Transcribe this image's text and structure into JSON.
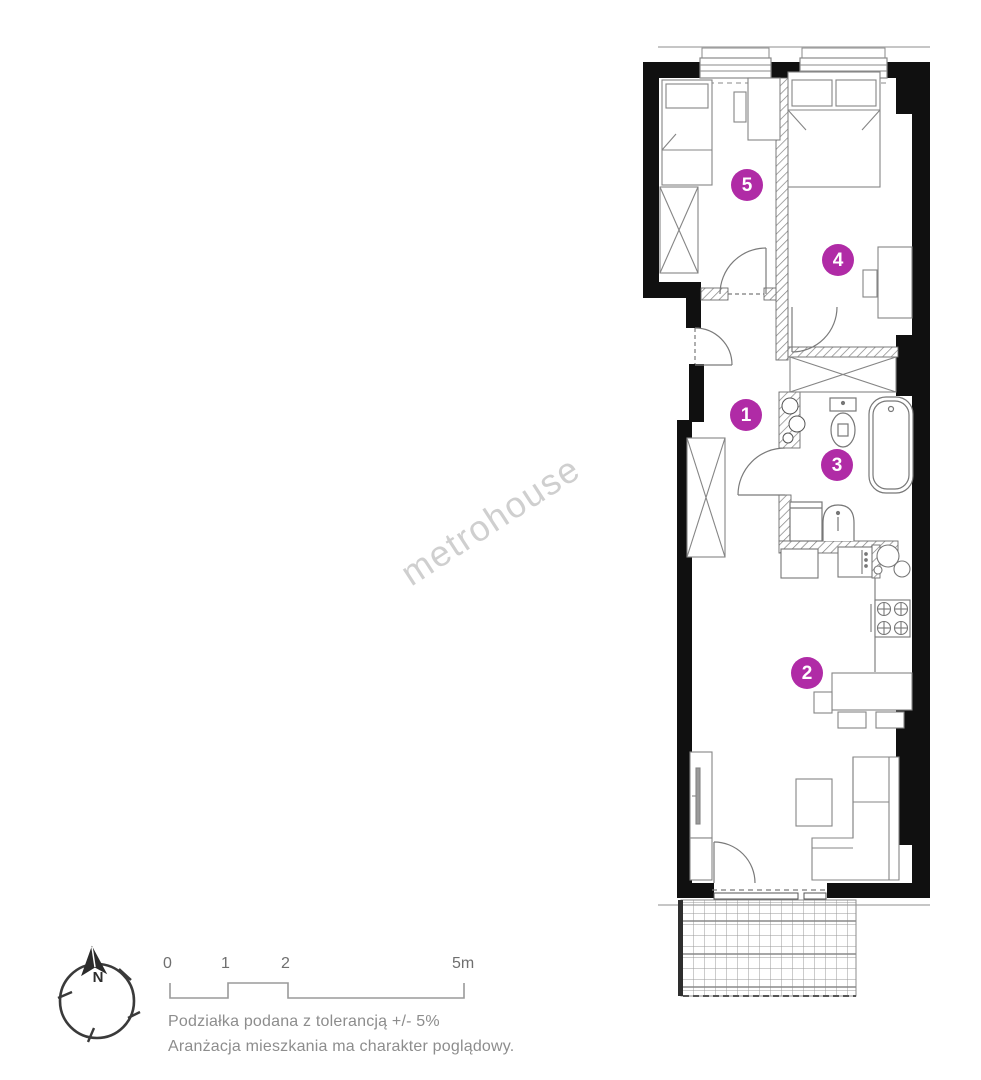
{
  "watermark": {
    "text": "metrohouse"
  },
  "colors": {
    "accent": "#b02ba6",
    "walls": "#101010",
    "linework": "#7a7a7a"
  },
  "rooms": [
    {
      "number": "1"
    },
    {
      "number": "2"
    },
    {
      "number": "3"
    },
    {
      "number": "4"
    },
    {
      "number": "5"
    }
  ],
  "compass": {
    "north_label": "N"
  },
  "scale_bar": {
    "tick_labels": [
      "0",
      "1",
      "2",
      "5m"
    ]
  },
  "footnotes": [
    "Podziałka podana z tolerancją +/- 5%",
    "Aranżacja mieszkania ma charakter poglądowy."
  ]
}
